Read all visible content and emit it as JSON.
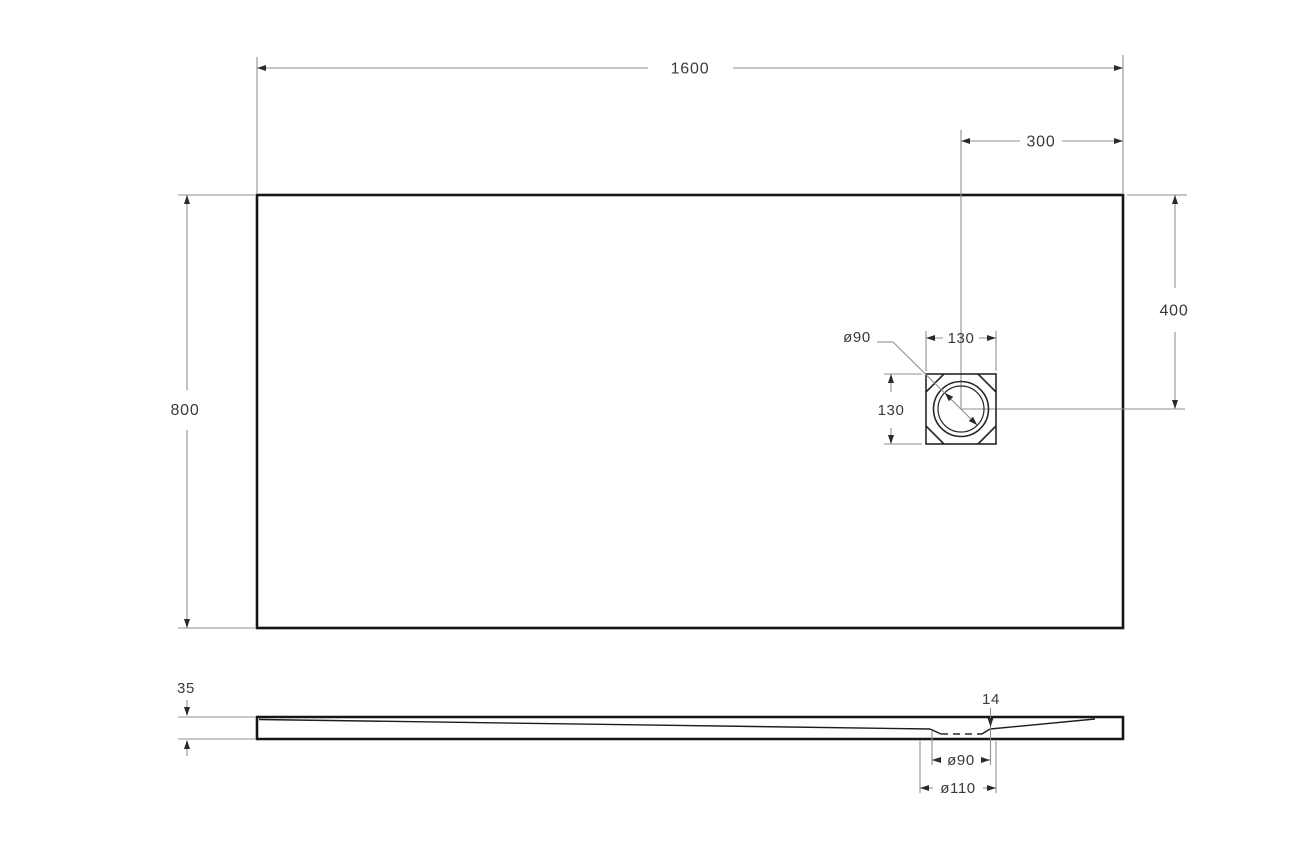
{
  "drawing": {
    "type": "technical-dimension-drawing",
    "subject": "rectangular shower tray with square drain",
    "background_color": "#ffffff",
    "colors": {
      "outline": "#161616",
      "dimension_line": "#8f8f8f",
      "arrow": "#2a2a2a",
      "label_text": "#3a3a3a"
    },
    "top_view": {
      "labels": {
        "overall_width": "1600",
        "overall_depth": "800",
        "drain_offset_from_right": "300",
        "drain_offset_from_top": "400",
        "drain_box_width": "130",
        "drain_box_height": "130",
        "drain_diameter": "ø90"
      }
    },
    "side_view": {
      "labels": {
        "tray_height": "35",
        "drain_recess_depth": "14",
        "drain_hole_diameter": "ø90",
        "drain_flange_diameter": "ø110"
      }
    }
  }
}
